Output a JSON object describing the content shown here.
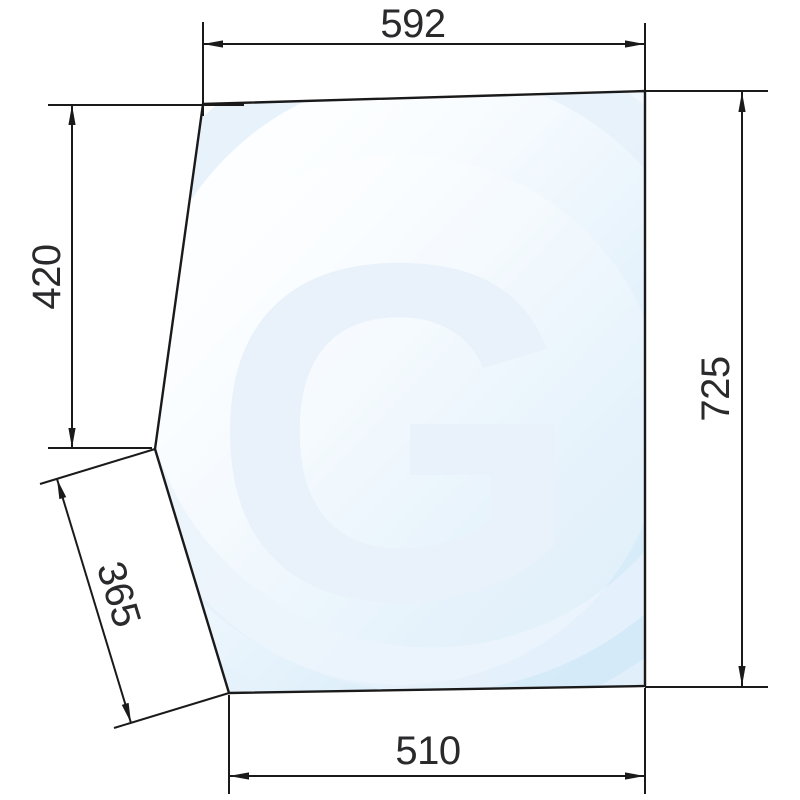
{
  "drawing": {
    "type": "technical-dimension-drawing",
    "subject": "cab window glass pane outline with dimension lines",
    "watermark_letter": "G",
    "dims": {
      "top": "592",
      "left": "420",
      "lower_left": "365",
      "right": "725",
      "bottom": "510"
    }
  },
  "colors": {
    "line": "#1a1a1a",
    "text": "#2a2a2c",
    "glass_light": "#ffffff",
    "glass_mid": "#edf6fd",
    "glass_deep": "#d4eaf8",
    "watermark": "#e9f2fa",
    "ring": "#e6f1fb"
  }
}
